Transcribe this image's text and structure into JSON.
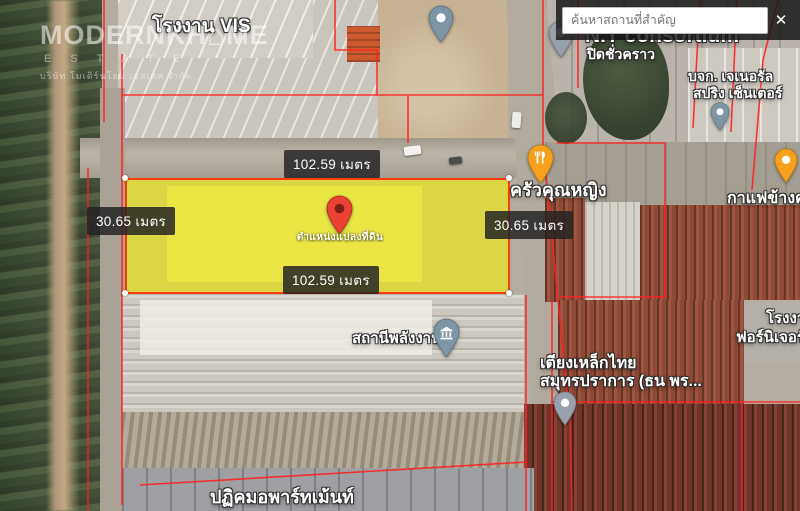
{
  "app": {
    "search_placeholder": "ค้นหาสถานที่สำคัญ",
    "close_icon": "✕"
  },
  "watermark": {
    "brand_left": "MODERNKH",
    "house_glyph": "⌂",
    "brand_right": "ME",
    "estate": "E S T A T E",
    "company": "บริษัท โมเดิร์นโฮม เอสเตท จำกัด"
  },
  "plot": {
    "caption": "ตำแหน่งแปลงที่ดิน",
    "fill_color": "#f0eb14",
    "border_color": "#ff3c00"
  },
  "dimensions": {
    "top": "102.59 เมตร",
    "bottom": "102.59 เมตร",
    "left": "30.65 เมตร",
    "right": "30.65 เมตร"
  },
  "places": {
    "factory_vis": {
      "label": "โรงงาน VIS"
    },
    "nt_consortium": {
      "name": "N.T consortium",
      "status": "ปิดชั่วคราว"
    },
    "general_spring": {
      "line1": "บจก. เจเนอรัล",
      "line2": "สปริง เซ็นเตอร์"
    },
    "krua_khunying": {
      "label": "ครัวคุณหญิง"
    },
    "coffee": {
      "label": "กาแฟข้างค"
    },
    "energy_station": {
      "label": "สถานีพลังงาน"
    },
    "steel_bed": {
      "line1": "เตียงเหล็กไทย",
      "line2": "สมุทรปราการ (ธน พร..."
    },
    "furniture": {
      "line1": "โรงงา",
      "line2": "ฟอร์นิเจอร์ บ"
    },
    "apartment": {
      "label": "ปฏิคมอพาร์ทเม้นท์"
    }
  },
  "colors": {
    "cadastral_line": "#ff2020",
    "pin_red": "#ea4335",
    "pin_orange": "#f6a01d",
    "pin_slate": "#7d95a5",
    "pin_gray": "#98a1ab"
  }
}
